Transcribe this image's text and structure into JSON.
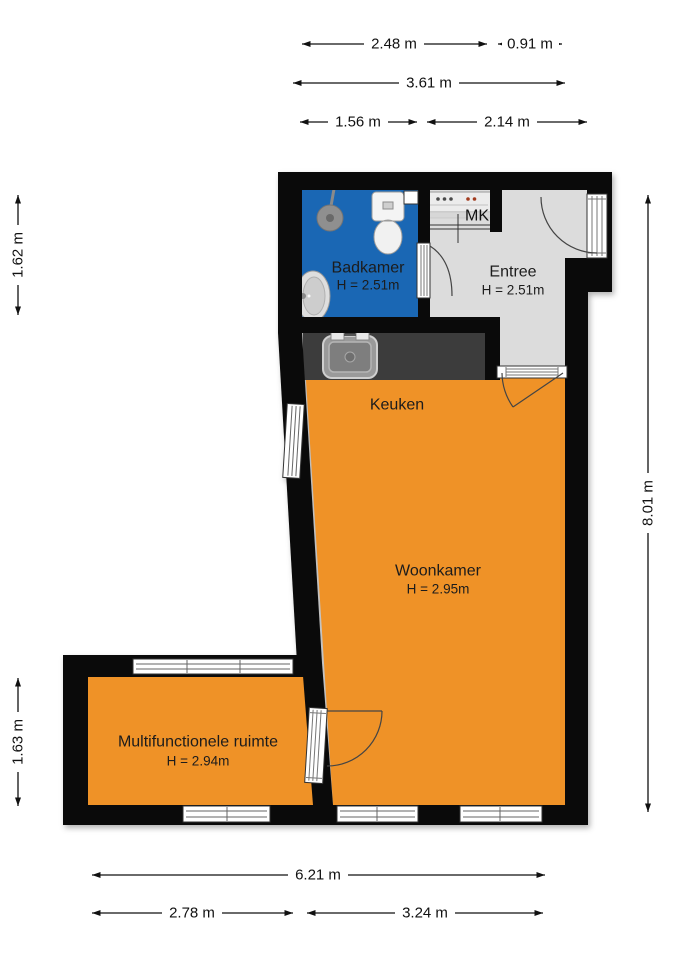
{
  "title": "Floor plan (plattegrond)",
  "colors": {
    "wall": "#0a0a0a",
    "badkamer_blue": "#1a67b4",
    "orange": "#ef9227",
    "entree_gray": "#dcdcdc",
    "counter_gray": "#3c3c3c"
  },
  "plan": {
    "rooms": {
      "badkamer": {
        "name": "Badkamer",
        "height": "H = 2.51m"
      },
      "entree": {
        "name": "Entree",
        "height": "H = 2.51m"
      },
      "keuken": {
        "name": "Keuken"
      },
      "woonkamer": {
        "name": "Woonkamer",
        "height": "H = 2.95m"
      },
      "multifunctionele_ruimte": {
        "name": "Multifunctionele ruimte",
        "height": "H = 2.94m"
      },
      "meterkast": {
        "name": "MK"
      }
    },
    "dimensions": {
      "top_row1_left": "2.48 m",
      "top_row1_right": "0.91 m",
      "top_row2": "3.61 m",
      "top_row3_left": "1.56 m",
      "top_row3_right": "2.14 m",
      "left_upper": "1.62 m",
      "left_lower": "1.63 m",
      "right_total": "8.01 m",
      "bottom_total": "6.21 m",
      "bottom_left": "2.78 m",
      "bottom_right": "3.24 m"
    }
  }
}
